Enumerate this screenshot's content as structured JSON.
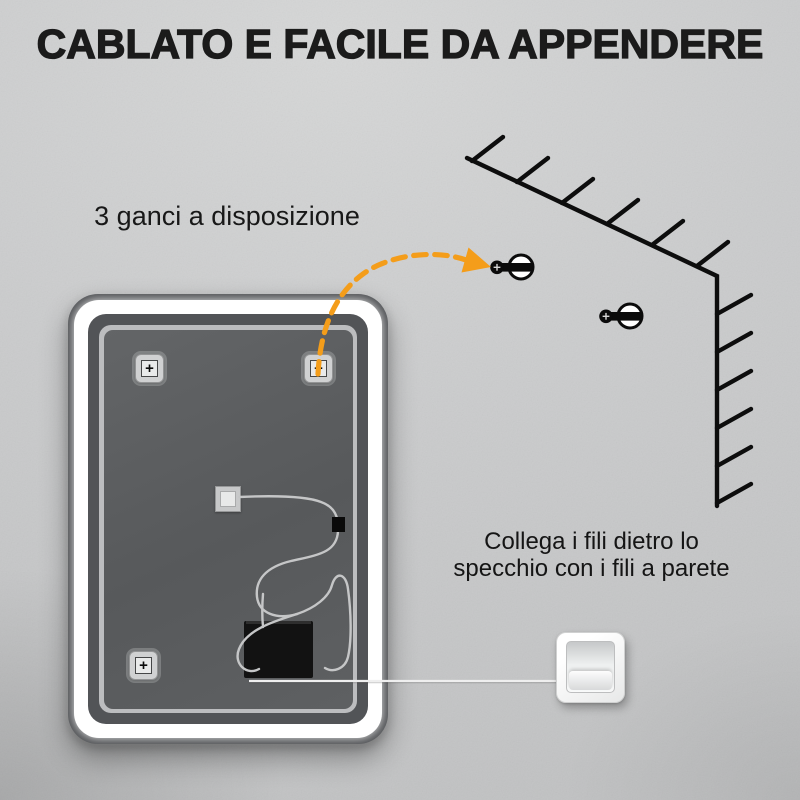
{
  "title": "CABLATO E FACILE DA APPENDERE",
  "annotations": {
    "hooks": "3 ganci a disposizione",
    "wiring": [
      "Collega i fili dietro lo",
      "specchio con i fili a parete"
    ]
  },
  "icons": {
    "screw_cross_glyph": "+",
    "wall_hook": "wall-hook-screw-icon",
    "arrow": "dashed-arrow-icon",
    "wall_corner": "wall-corner-hatch-icon",
    "light_switch": "light-switch-icon",
    "junction_box": "junction-box-icon"
  },
  "colors": {
    "wall": "#cbcccd",
    "frame_dark": "#55575a",
    "led_white": "#ffffff",
    "inner_ring_gray": "#bcbdbf",
    "backing_gray": "#5b5d5f",
    "accent_orange": "#f49d1a",
    "line_black": "#0d0d0d",
    "wire_gray": "#c5c6c7",
    "text_dark": "#1b1b1b"
  }
}
